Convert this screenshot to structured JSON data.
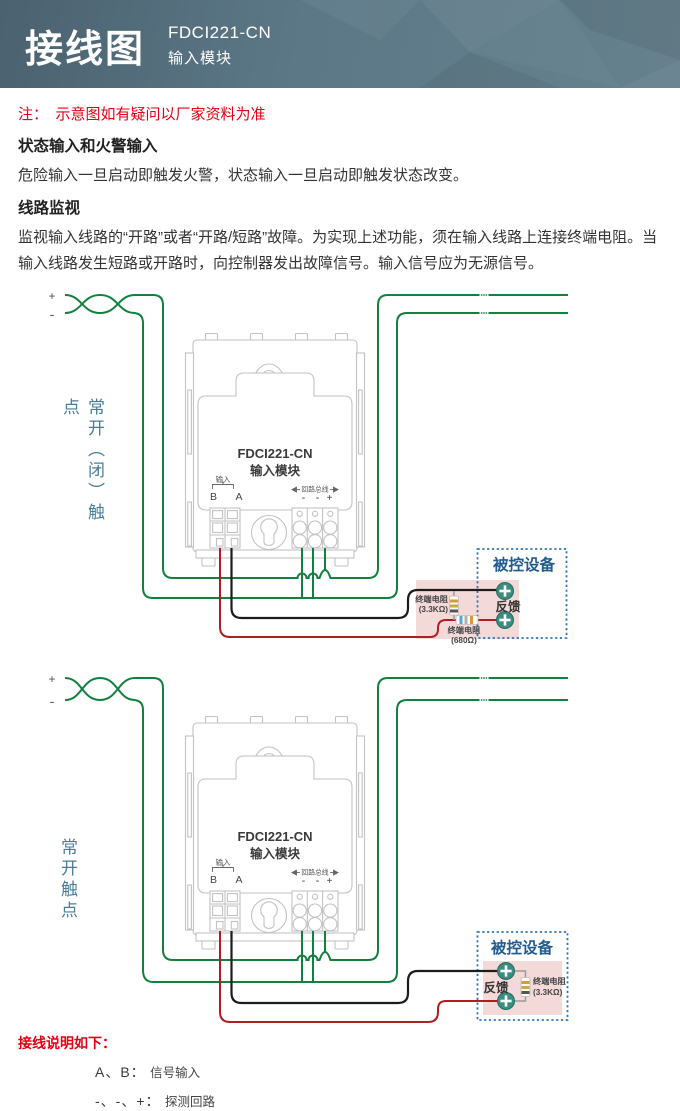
{
  "header": {
    "title": "接线图",
    "model": "FDCI221-CN",
    "subtitle": "输入模块"
  },
  "intro": {
    "note": "注：　示意图如有疑问以厂家资料为准",
    "heading1": "状态输入和火警输入",
    "para1": "危险输入一旦启动即触发火警，状态输入一旦启动即触发状态改变。",
    "heading2": "线路监视",
    "para2": "监视输入线路的“开路”或者“开路/短路”故障。为实现上述功能，须在输入线路上连接终端电阻。当输入线路发生短路或开路时，向控制器发出故障信号。输入信号应为无源信号。"
  },
  "module": {
    "model": "FDCI221-CN",
    "type": "输入模块",
    "input_label": "输入",
    "terminal_b": "B",
    "terminal_a": "A",
    "loop_label": "回路总线",
    "minus1": "-",
    "minus2": "-",
    "plus": "+"
  },
  "diagram1": {
    "side_label": "常开（闭）触点",
    "plus": "+",
    "minus": "-",
    "device_title": "被控设备",
    "feedback": "反馈",
    "eol_resistor_line1": "终端电阻",
    "eol_resistor_line2": "(3.3KΩ)",
    "series_resistor_line1": "终端电阻",
    "series_resistor_line2": "(680Ω)"
  },
  "diagram2": {
    "side_label": "常开触点",
    "plus": "+",
    "minus": "-",
    "device_title": "被控设备",
    "feedback": "反馈",
    "eol_resistor_line1": "终端电阻",
    "eol_resistor_line2": "(3.3KΩ)"
  },
  "legend": {
    "title": "接线说明如下：",
    "items": [
      {
        "term": "A、B：",
        "desc": "信号输入"
      },
      {
        "term": "-、-、+：",
        "desc": "探测回路"
      }
    ]
  },
  "colors": {
    "wire_green": "#12813f",
    "wire_red": "#b01e23",
    "wire_black": "#1c1c1c",
    "device_box_fill": "#f4d9d9",
    "device_box_border": "#2f74b5",
    "device_title_text": "#215c90",
    "side_label_text": "#4a7d98",
    "note_red": "#e60012",
    "header_bg": "#5c7887",
    "screw_teal": "#3a8d80"
  }
}
